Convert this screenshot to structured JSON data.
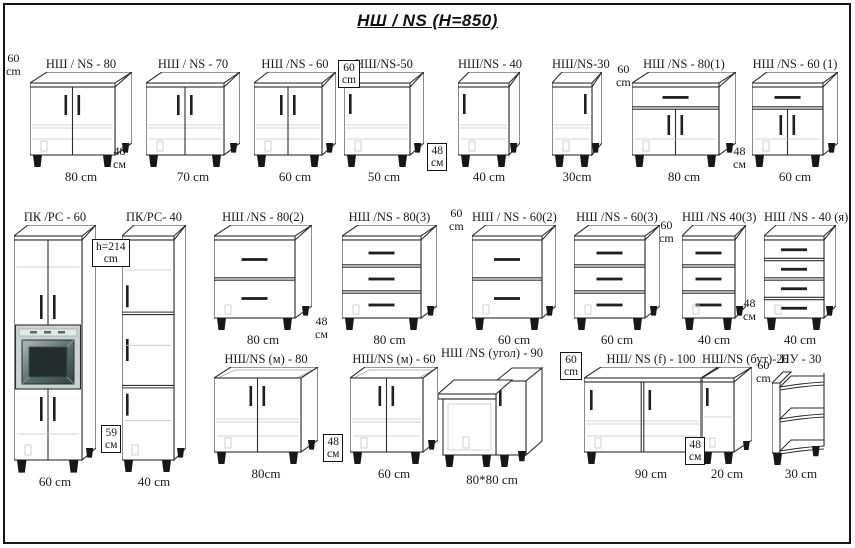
{
  "title": "НШ / NS  (H=850)",
  "colors": {
    "line": "#2e2e2e",
    "background": "#ffffff",
    "feet": "#171717",
    "oven_frame": "#cbd3d2",
    "oven_screen_dark": "#324240",
    "oven_screen_light": "#aebdba"
  },
  "cabinets": [
    {
      "name": "НШ / NS - 80",
      "dim": "80 cm",
      "kind": "two-doors"
    },
    {
      "name": "НШ / NS - 70",
      "dim": "70 cm",
      "kind": "two-doors"
    },
    {
      "name": "НШ /NS - 60",
      "dim": "60 cm",
      "kind": "two-doors"
    },
    {
      "name": "НШ/NS-50",
      "dim": "50 cm",
      "kind": "one-door-left"
    },
    {
      "name": "НШ/NS - 40",
      "dim": "40 cm",
      "kind": "one-door-left"
    },
    {
      "name": "НШ/NS-30",
      "dim": "30cm",
      "kind": "one-door-right"
    },
    {
      "name": "НШ /NS - 80(1)",
      "dim": "80 cm",
      "kind": "drawer-two-doors"
    },
    {
      "name": "НШ /NS - 60 (1)",
      "dim": "60 cm",
      "kind": "drawer-two-doors"
    },
    {
      "name": "ПК /РС - 60",
      "dim": "60 cm",
      "kind": "tall-oven"
    },
    {
      "name": "ПК/РС- 40",
      "dim": "40 cm",
      "kind": "tall-three-doors"
    },
    {
      "name": "НШ /NS - 80(2)",
      "dim": "80 cm",
      "kind": "drawers",
      "count": 2
    },
    {
      "name": "НШ /NS - 80(3)",
      "dim": "80 cm",
      "kind": "drawers",
      "count": 3
    },
    {
      "name": "НШ / NS - 60(2)",
      "dim": "60 cm",
      "kind": "drawers",
      "count": 2
    },
    {
      "name": "НШ /NS - 60(3)",
      "dim": "60 cm",
      "kind": "drawers",
      "count": 3
    },
    {
      "name": "НШ /NS 40(3)",
      "dim": "40 cm",
      "kind": "drawers",
      "count": 3
    },
    {
      "name": "НШ /NS - 40 (я)",
      "dim": "40 cm",
      "kind": "drawers",
      "count": 4
    },
    {
      "name": "НШ/NS (м) - 80",
      "dim": "80cm",
      "kind": "sink-two-doors"
    },
    {
      "name": "НШ/NS (м) - 60",
      "dim": "60 cm",
      "kind": "sink-two-doors"
    },
    {
      "name": "НШ /NS (угол) - 90",
      "dim": "80*80 cm",
      "kind": "corner"
    },
    {
      "name": "НШ/ NS (f) - 100",
      "dim": "90 cm",
      "kind": "two-doors-wide"
    },
    {
      "name": "НШ/NS (бут)-20",
      "dim": "20 cm",
      "kind": "bottle"
    },
    {
      "name": "НУ - 30",
      "dim": "30 cm",
      "kind": "open-shelves"
    }
  ],
  "annotations": [
    {
      "text": "60\ncm",
      "boxed": false
    },
    {
      "text": "48\nсм",
      "boxed": false
    },
    {
      "text": "60\ncm",
      "boxed": true
    },
    {
      "text": "48\nсм",
      "boxed": true
    },
    {
      "text": "60\ncm",
      "boxed": false
    },
    {
      "text": "48\nсм",
      "boxed": false
    },
    {
      "text": "h=214\ncm",
      "boxed": true
    },
    {
      "text": "59\nсм",
      "boxed": true
    },
    {
      "text": "48\nсм",
      "boxed": false
    },
    {
      "text": "60\ncm",
      "boxed": false
    },
    {
      "text": "60\ncm",
      "boxed": false
    },
    {
      "text": "48\nсм",
      "boxed": false
    },
    {
      "text": "48\nсм",
      "boxed": true
    },
    {
      "text": "60\ncm",
      "boxed": true
    },
    {
      "text": "48\nсм",
      "boxed": true
    },
    {
      "text": "60\ncm",
      "boxed": false
    }
  ]
}
